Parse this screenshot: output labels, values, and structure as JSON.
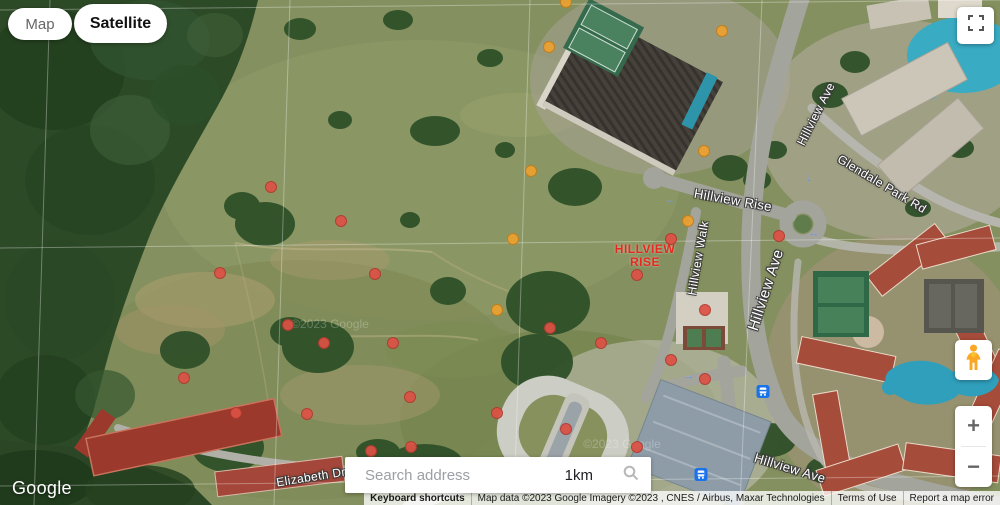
{
  "map_controls": {
    "map_label": "Map",
    "satellite_label": "Satellite"
  },
  "search": {
    "placeholder": "Search address",
    "scale_text": "1km"
  },
  "zoom_controls": {
    "zoom_in": "+",
    "zoom_out": "−"
  },
  "logo_text": "Google",
  "attribution": {
    "keyboard_shortcuts": "Keyboard shortcuts",
    "map_data": "Map data ©2023 Google Imagery ©2023 , CNES / Airbus, Maxar Technologies",
    "terms": "Terms of Use",
    "report": "Report a map error"
  },
  "icons": {
    "fullscreen": "corner-brackets",
    "pegman": "street-view-person",
    "search": "magnifier",
    "bus": "bus-stop",
    "zoom_in": "plus",
    "zoom_out": "minus"
  },
  "site_label": {
    "line1": "HILLVIEW",
    "line2": "RISE",
    "x": 645,
    "y": 256,
    "color": "#e8281e"
  },
  "road_labels": [
    {
      "text": "Hillview Rise",
      "x": 733,
      "y": 200,
      "rot": 10,
      "size": 13
    },
    {
      "text": "Hillview Walk",
      "x": 698,
      "y": 258,
      "rot": -80,
      "size": 12
    },
    {
      "text": "Hillview Ave",
      "x": 766,
      "y": 290,
      "rot": -72,
      "size": 15
    },
    {
      "text": "Hillview Ave",
      "x": 816,
      "y": 114,
      "rot": -63,
      "size": 12
    },
    {
      "text": "Glendale Park Rd",
      "x": 882,
      "y": 184,
      "rot": 31,
      "size": 12
    },
    {
      "text": "Hillview Ave",
      "x": 790,
      "y": 468,
      "rot": 17,
      "size": 13
    },
    {
      "text": "Elizabeth Dr",
      "x": 311,
      "y": 477,
      "rot": -9,
      "size": 12
    }
  ],
  "watermarks": [
    {
      "text": "©2023 Google",
      "x": 330,
      "y": 324
    },
    {
      "text": "©2023 Google",
      "x": 622,
      "y": 444
    }
  ],
  "markers": {
    "colors": {
      "red": "#dd5145",
      "orange": "#eda131"
    },
    "points": [
      {
        "x": 271,
        "y": 187,
        "c": "red"
      },
      {
        "x": 341,
        "y": 221,
        "c": "red"
      },
      {
        "x": 220,
        "y": 273,
        "c": "red"
      },
      {
        "x": 375,
        "y": 274,
        "c": "red"
      },
      {
        "x": 288,
        "y": 325,
        "c": "red"
      },
      {
        "x": 324,
        "y": 343,
        "c": "red"
      },
      {
        "x": 393,
        "y": 343,
        "c": "red"
      },
      {
        "x": 184,
        "y": 378,
        "c": "red"
      },
      {
        "x": 236,
        "y": 413,
        "c": "red"
      },
      {
        "x": 307,
        "y": 414,
        "c": "red"
      },
      {
        "x": 410,
        "y": 397,
        "c": "red"
      },
      {
        "x": 411,
        "y": 447,
        "c": "red"
      },
      {
        "x": 371,
        "y": 451,
        "c": "red"
      },
      {
        "x": 497,
        "y": 413,
        "c": "red"
      },
      {
        "x": 550,
        "y": 328,
        "c": "red"
      },
      {
        "x": 566,
        "y": 429,
        "c": "red"
      },
      {
        "x": 601,
        "y": 343,
        "c": "red"
      },
      {
        "x": 637,
        "y": 275,
        "c": "red"
      },
      {
        "x": 637,
        "y": 447,
        "c": "red"
      },
      {
        "x": 671,
        "y": 239,
        "c": "red"
      },
      {
        "x": 671,
        "y": 360,
        "c": "red"
      },
      {
        "x": 705,
        "y": 310,
        "c": "red"
      },
      {
        "x": 705,
        "y": 379,
        "c": "red"
      },
      {
        "x": 779,
        "y": 236,
        "c": "red"
      },
      {
        "x": 566,
        "y": 2,
        "c": "orange"
      },
      {
        "x": 549,
        "y": 47,
        "c": "orange"
      },
      {
        "x": 722,
        "y": 31,
        "c": "orange"
      },
      {
        "x": 704,
        "y": 151,
        "c": "orange"
      },
      {
        "x": 531,
        "y": 171,
        "c": "orange"
      },
      {
        "x": 513,
        "y": 239,
        "c": "orange"
      },
      {
        "x": 688,
        "y": 221,
        "c": "orange"
      },
      {
        "x": 497,
        "y": 310,
        "c": "orange"
      }
    ]
  },
  "bus_stops": [
    {
      "x": 763,
      "y": 394
    },
    {
      "x": 701,
      "y": 477
    }
  ],
  "road_arrows": [
    {
      "glyph": "←",
      "x": 670,
      "y": 200
    },
    {
      "glyph": "↓",
      "x": 809,
      "y": 178
    },
    {
      "glyph": "→",
      "x": 689,
      "y": 376
    },
    {
      "glyph": "←",
      "x": 814,
      "y": 233
    }
  ]
}
